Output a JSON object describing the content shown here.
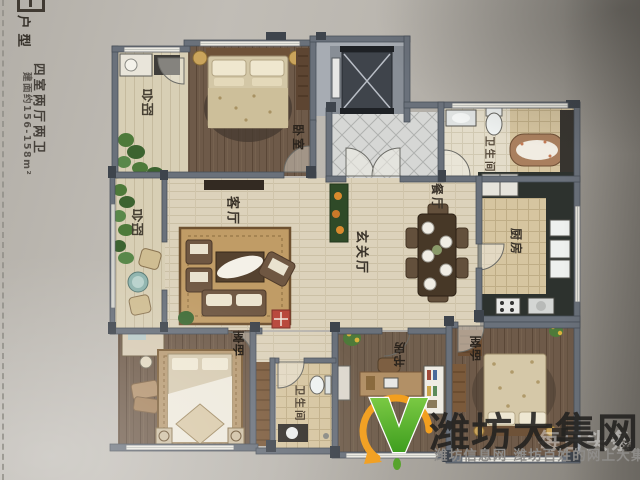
{
  "sidebar": {
    "brand_glyph": "王",
    "title": "户型",
    "layout": "四室两厅两卫",
    "area": "建面约156-158m²"
  },
  "rooms": {
    "balcony_top": "阳台",
    "bedroom_top": "卧室",
    "bathroom_top": "卫生间",
    "dining": "餐厅",
    "kitchen": "厨房",
    "balcony_left": "阳台",
    "living": "客厅",
    "hall": "玄关厅",
    "bedroom_left": "卧室",
    "bathroom_bottom": "卫生间",
    "study": "书房",
    "bedroom_right": "卧室"
  },
  "watermark": {
    "site_name": "潍坊大集网",
    "tagline": "潍坊信息网 潍坊百姓的网上大集",
    "mark": "※",
    "faint_text": "每日头条",
    "colors": {
      "logo_green": "#4fa32a",
      "logo_orange": "#f29f1f",
      "title": "#232220",
      "tagline_gray": "#8e8c89"
    }
  }
}
